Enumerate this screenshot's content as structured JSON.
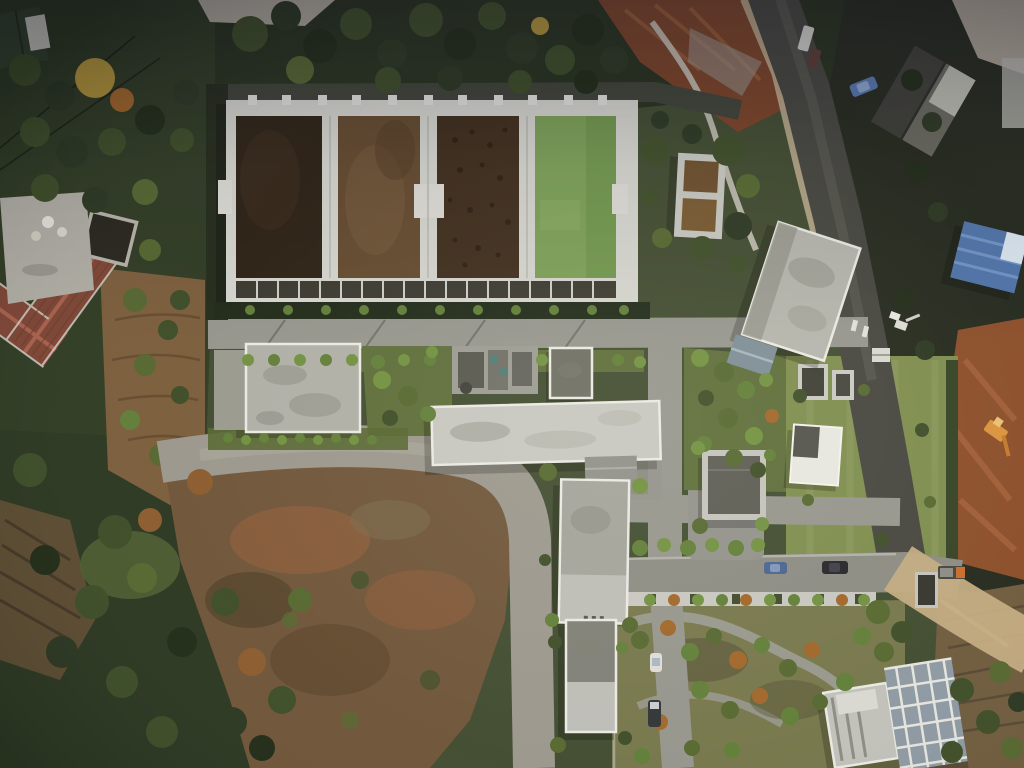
{
  "scene": {
    "title": "Aerial drone view of a wastewater treatment plant",
    "setting": "Top-down view: four rectangular treatment basins (three brown, one green), plant buildings, internal roads, surrounding forest, farmland, barren mound and construction sites",
    "time_of_day": "daytime, low sun from upper right"
  },
  "palette": {
    "ground_base": "#3f4a2e",
    "forest_dark": "#26301c",
    "forest_left": "#2e3a22",
    "forest_bottom": "#2a3620",
    "lawn": "#7c8c4c",
    "garden_base": "#75754a",
    "green_strip": "#5c6c38",
    "hedge_dark": "#222a1a",
    "barren_brown": "#6e5438",
    "barren_red": "#8a5a38",
    "terrace_brown": "#7a5c3a",
    "farm_plot": "#6e5a3c",
    "dirt_gray": "#9a968c",
    "dirt_light": "#c2b092",
    "rubble_gray": "#b0aa9c",
    "construction_orange": "#7a4226",
    "construction_orange2": "#8a4c28",
    "road_asphalt": "#94948c",
    "road_dark": "#44443e",
    "walkway": "#c6c6c0",
    "concrete_frame": "#d6d6d0",
    "channel_dark": "#3a372e",
    "pool1_dark_brown": "#2b2013",
    "pool2_brown": "#63492d",
    "pool3_mottled_brown": "#3d2b1a",
    "pool4_green": "#7aa055",
    "tank_water_top": "#6b4e2a",
    "tank_water_bottom": "#77582e",
    "roof_light": "#c6c6c0",
    "roof_mid": "#aeaea6",
    "roof_gray": "#a2a29a",
    "roof_pale": "#bcbcb6",
    "roof_dark": "#5a5a52",
    "roof_darker": "#7e7e76",
    "roof_blue": "#4e72a8",
    "roof_blue_light": "#d8e4ee",
    "roof_red_tile": "#7e4434",
    "roof_red_ridge": "#a8604a",
    "house_dark": "#3c3c36",
    "house_green_roof": "#34422c",
    "white_roof": "#e6e6e0",
    "scaffold_face": "#8c98a2",
    "equipment_teal": "#4e7a72",
    "car_blue": "#46628f",
    "car_dark": "#23232a",
    "car_white": "#dcdcd8",
    "truck_orange": "#c96a28",
    "excavator_yellow": "#d8913a"
  },
  "objects": {
    "treatment_basins": {
      "label": "four rectangular treatment basins in a concrete frame",
      "pools": [
        {
          "name": "basin-1",
          "surface": "very dark brown wastewater"
        },
        {
          "name": "basin-2",
          "surface": "lighter brown wastewater"
        },
        {
          "name": "basin-3",
          "surface": "mottled dark sludge"
        },
        {
          "name": "basin-4",
          "surface": "green treated water"
        }
      ]
    },
    "square_tanks": {
      "label": "twin square concrete tanks with brown water",
      "count": 2
    },
    "buildings": [
      "flat-roof building west",
      "equipment platform",
      "small dark-roof hut",
      "long light-gray building",
      "mid plant building",
      "small south building",
      "dark-roof building east",
      "white-roof building on lawn",
      "lawn sheds",
      "large tilted building northeast",
      "blue-roof building east edge",
      "dark pitched-roof house northeast",
      "red-tile L-shaped farmhouse west",
      "green-roof house northwest corner",
      "scaffolded building southeast"
    ],
    "vehicles": [
      "blue car on south road",
      "dark SUV on south road",
      "white car on east lane",
      "dark pickup on east lane",
      "blue car parked northeast",
      "white van northeast road",
      "orange truck southeast"
    ],
    "terrain": [
      "dense forest top and west",
      "barren eroded mound center-south",
      "gray haul road around mound",
      "terraced farmland west",
      "construction site with orange soil east",
      "large lawn east",
      "landscaped garden with winding paths southeast",
      "farm plots southeast corner"
    ]
  }
}
